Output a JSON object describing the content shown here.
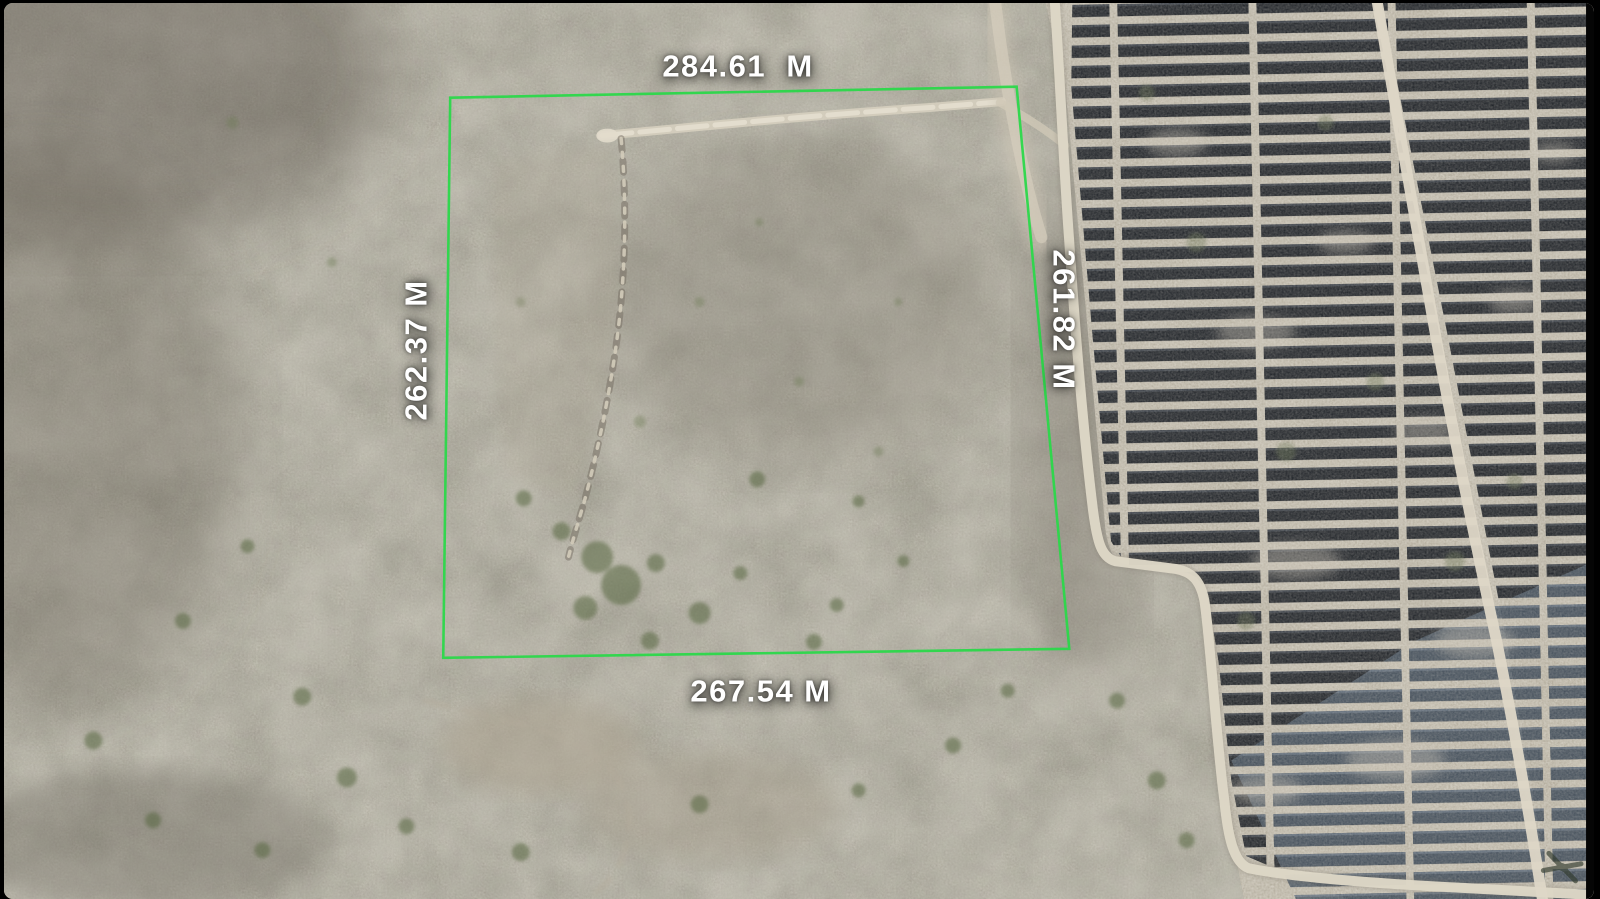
{
  "parcel": {
    "boundary_color": "#2bd84a",
    "measurements": {
      "top": "284.61  M",
      "left": "262.37 M",
      "right": "261.82 M",
      "bottom": "267.54 M"
    }
  },
  "scene": {
    "road_color": "#ded7c7",
    "panel_color_dark": "#14181e",
    "panel_color_light": "#3d4a58",
    "terrain_color": "#837c70"
  }
}
